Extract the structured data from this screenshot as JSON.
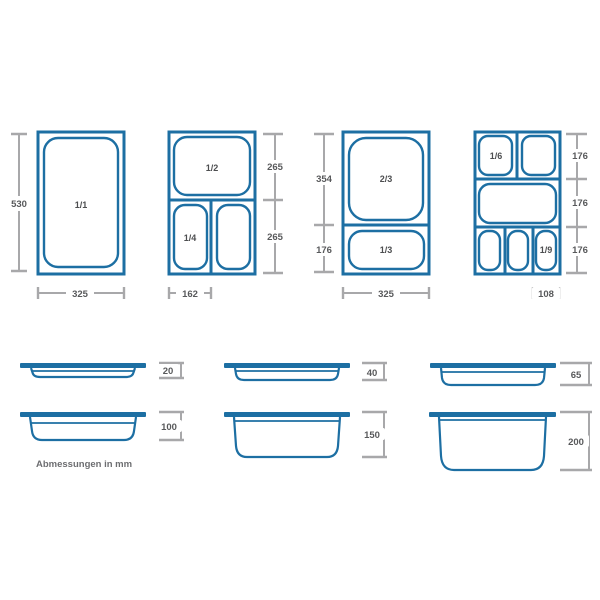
{
  "colors": {
    "background": "#ffffff",
    "pan-blue": "#1d6fa3",
    "dim-line": "#a8a8aa",
    "dim-text": "#58595b",
    "pan-label": "#4d4e50",
    "caption-text": "#6d6e71"
  },
  "caption": "Abmessungen in mm",
  "top_views": {
    "gn11": {
      "label": "1/1",
      "dim_height": "530",
      "dim_width": "325"
    },
    "gn12": {
      "label_top": "1/2",
      "label_bottom_left": "1/4",
      "dim_top": "265",
      "dim_bottom": "265",
      "dim_width": "162"
    },
    "gn23": {
      "label_top": "2/3",
      "label_bottom": "1/3",
      "dim_top": "354",
      "dim_bottom": "176",
      "dim_width": "325"
    },
    "gn16": {
      "label_top_left": "1/6",
      "label_bottom_right": "1/9",
      "dim_row1": "176",
      "dim_row2": "176",
      "dim_row3": "176",
      "dim_width": "108"
    }
  },
  "side_views": {
    "depths": [
      "20",
      "40",
      "65",
      "100",
      "150",
      "200"
    ]
  }
}
